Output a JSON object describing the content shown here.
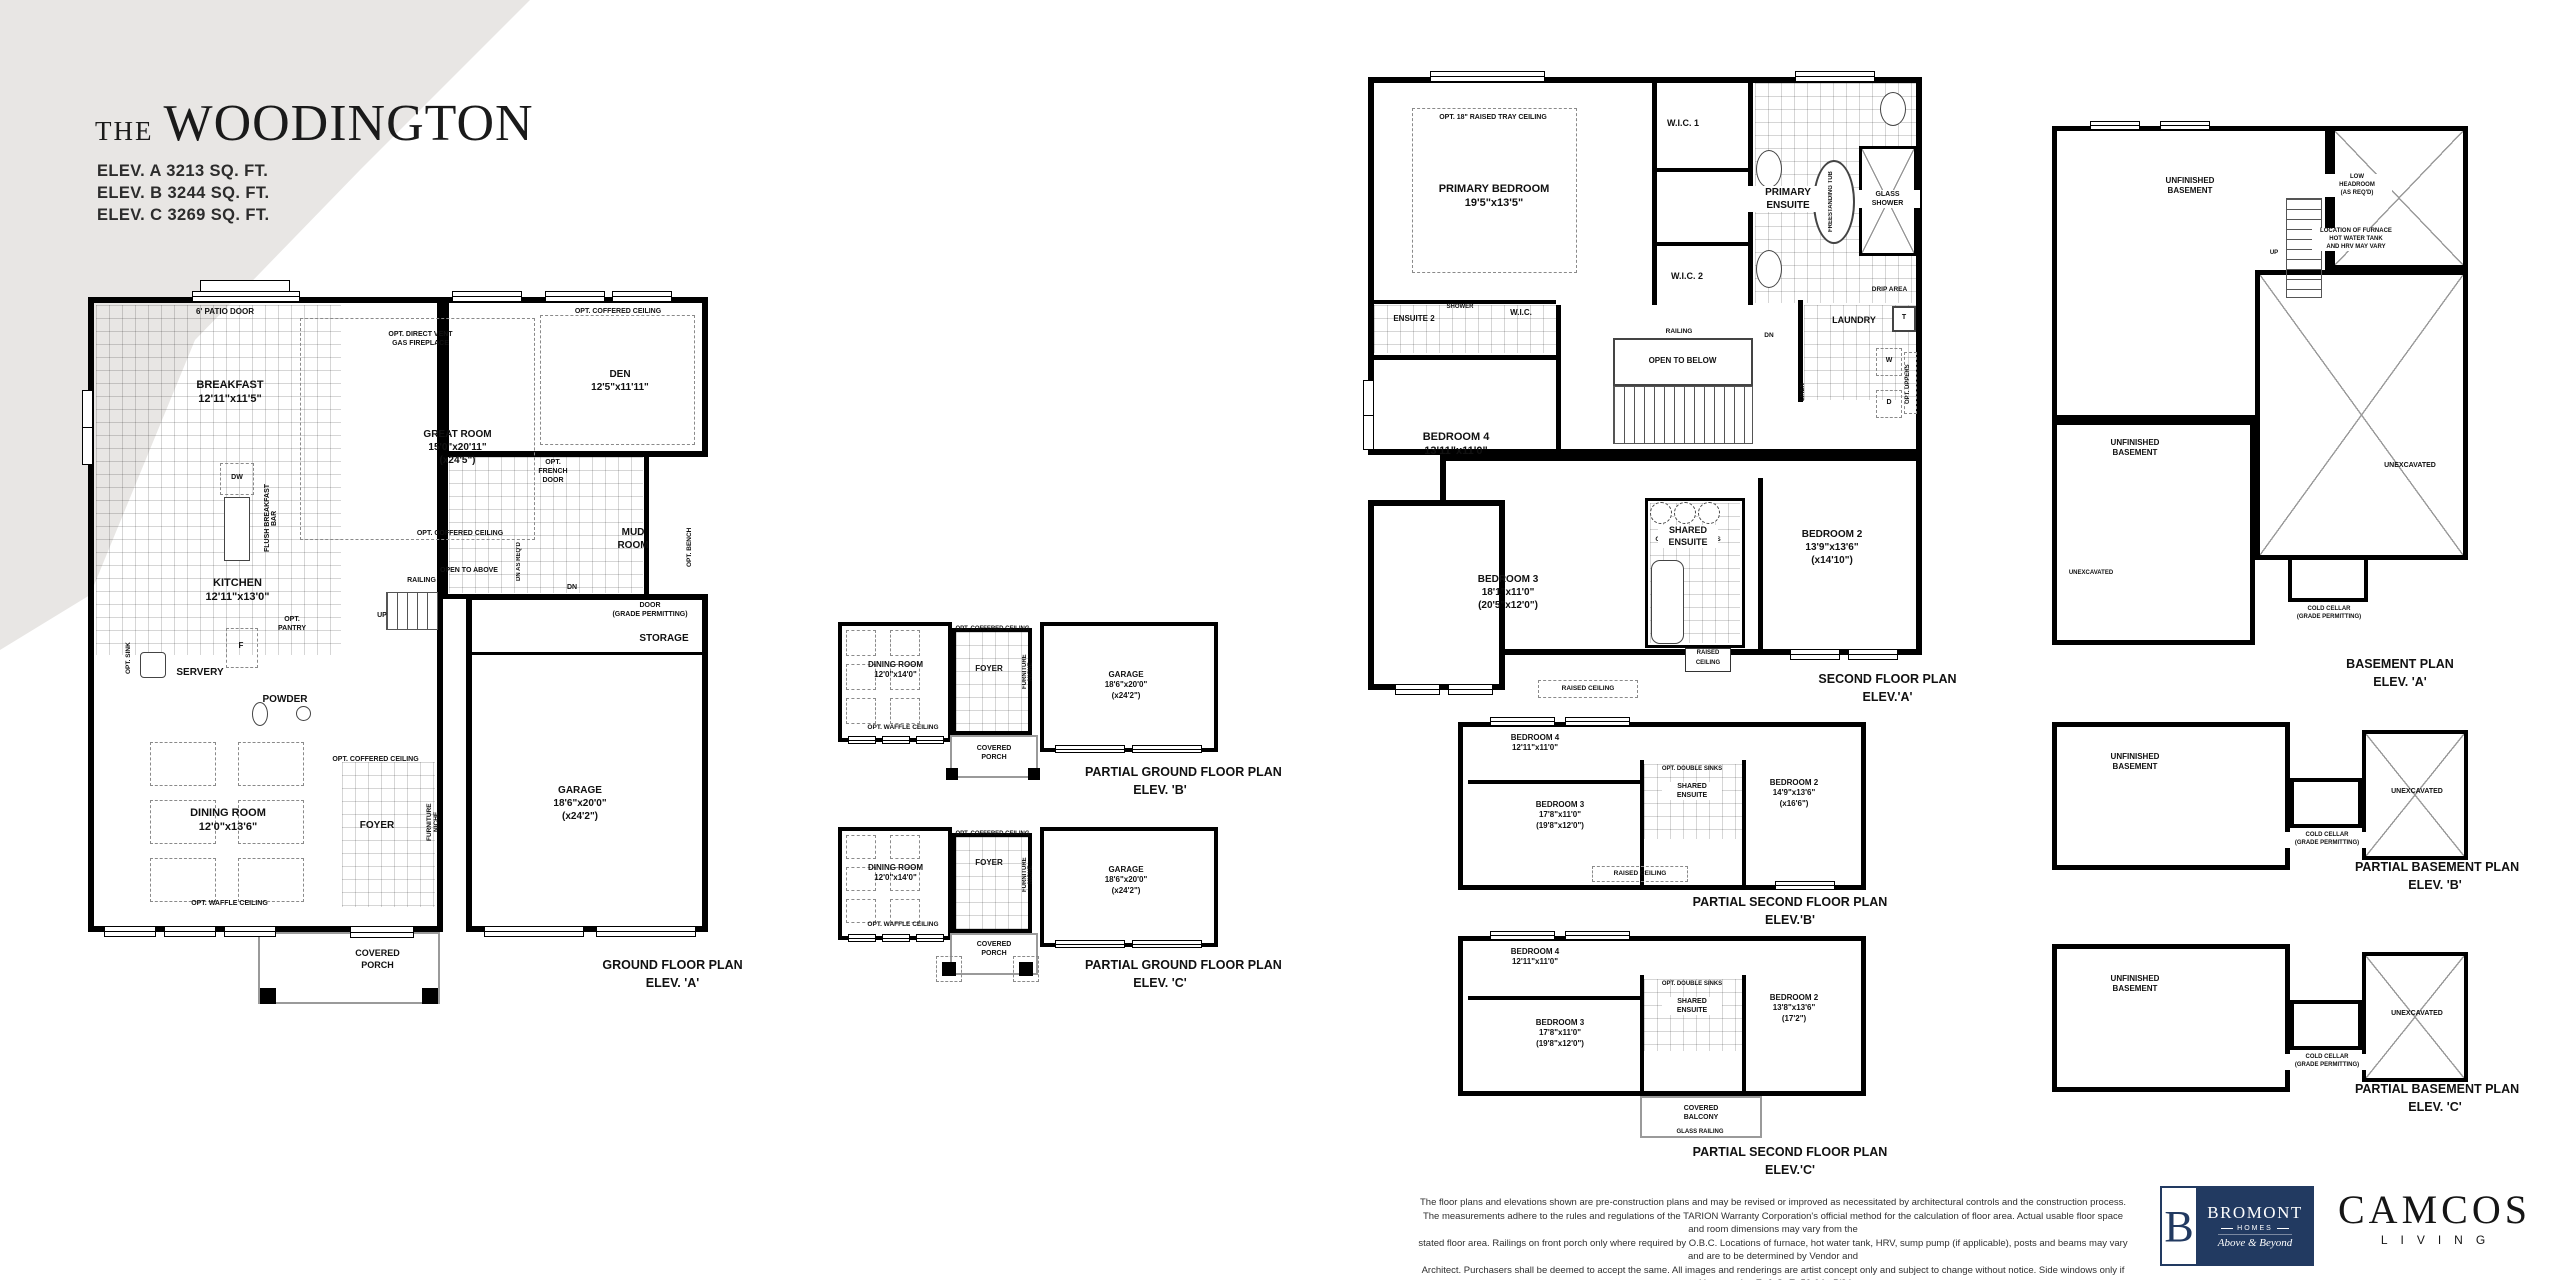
{
  "colors": {
    "paper": "#ffffff",
    "wedge": "#e8e6e4",
    "ink": "#111111",
    "bromont_navy": "#223a61"
  },
  "header": {
    "title_the": "THE",
    "title_name": "WOODINGTON",
    "elevations": [
      "ELEV. A 3213 SQ. FT.",
      "ELEV. B 3244 SQ. FT.",
      "ELEV. C 3269 SQ. FT."
    ]
  },
  "plans": {
    "ground_a": {
      "caption": [
        "GROUND FLOOR PLAN",
        "ELEV. 'A'"
      ],
      "labels": {
        "patio_door": "6' PATIO DOOR",
        "breakfast": [
          "BREAKFAST",
          "12'11\"x11'5\""
        ],
        "fireplace": [
          "OPT. DIRECT VENT",
          "GAS FIREPLACE"
        ],
        "great_room": [
          "GREAT ROOM",
          "15'0\"x20'11\"",
          "(x24'5\")"
        ],
        "great_coffered": "OPT. COFFERED CEILING",
        "den": [
          "DEN",
          "12'5\"x11'11\""
        ],
        "den_coffered": "OPT. COFFERED CEILING",
        "dw": "DW",
        "flush_bar": "FLUSH BREAKFAST BAR",
        "kitchen": [
          "KITCHEN",
          "12'11\"x13'0\""
        ],
        "fridge": "F",
        "pantry": [
          "OPT.",
          "PANTRY"
        ],
        "opt_sink": "OPT. SINK",
        "servery": "SERVERY",
        "powder": "POWDER",
        "open_above": "OPEN TO ABOVE",
        "railing": "RAILING",
        "up": "UP",
        "dn_reqd": "DN AS REQ'D",
        "french_door": [
          "OPT.",
          "FRENCH",
          "DOOR"
        ],
        "mud": [
          "MUD",
          "ROOM"
        ],
        "bench": "OPT. BENCH",
        "dn": "DN",
        "door_grade": [
          "DOOR",
          "(GRADE PERMITTING)"
        ],
        "storage": "STORAGE",
        "dining": [
          "DINING ROOM",
          "12'0\"x13'6\""
        ],
        "waffle": "OPT. WAFFLE CEILING",
        "foyer_coffered": "OPT. COFFERED CEILING",
        "foyer": "FOYER",
        "niche": "FURNITURE NICHE",
        "garage": [
          "GARAGE",
          "18'6\"x20'0\"",
          "(x24'2\")"
        ],
        "porch": [
          "COVERED",
          "PORCH"
        ]
      }
    },
    "partial_ground_b": {
      "caption": [
        "PARTIAL GROUND FLOOR PLAN",
        "ELEV. 'B'"
      ],
      "labels": {
        "dining": [
          "DINING ROOM",
          "12'0\"x14'0\""
        ],
        "coffered": "OPT. COFFERED CEILING",
        "foyer": "FOYER",
        "niche": "FURNITURE NICHE",
        "waffle": "OPT. WAFFLE CEILING",
        "porch": [
          "COVERED",
          "PORCH"
        ],
        "garage": [
          "GARAGE",
          "18'6\"x20'0\"",
          "(x24'2\")"
        ]
      }
    },
    "partial_ground_c": {
      "caption": [
        "PARTIAL GROUND FLOOR PLAN",
        "ELEV. 'C'"
      ],
      "labels": {
        "dining": [
          "DINING ROOM",
          "12'0\"x14'0\""
        ],
        "coffered": "OPT. COFFERED CEILING",
        "foyer": "FOYER",
        "niche": "FURNITURE NICHE",
        "waffle": "OPT. WAFFLE CEILING",
        "porch": [
          "COVERED",
          "PORCH"
        ],
        "garage": [
          "GARAGE",
          "18'6\"x20'0\"",
          "(x24'2\")"
        ]
      }
    },
    "second_a": {
      "caption": [
        "SECOND FLOOR PLAN",
        "ELEV.'A'"
      ],
      "labels": {
        "tray": "OPT. 18\" RAISED TRAY CEILING",
        "primary": [
          "PRIMARY BEDROOM",
          "19'5\"x13'5\""
        ],
        "wic1": "W.I.C. 1",
        "wic2": "W.I.C. 2",
        "ensuite": [
          "PRIMARY",
          "ENSUITE"
        ],
        "tub": "FREESTANDING TUB",
        "glass_shower": [
          "GLASS",
          "SHOWER"
        ],
        "drip": "DRIP AREA",
        "ensuite2": "ENSUITE 2",
        "shower": "SHOWER",
        "wic": "W.I.C.",
        "railing": "RAILING",
        "open_below": "OPEN TO BELOW",
        "dn": "DN",
        "laundry": "LAUNDRY",
        "linen": "LINEN",
        "w": "W",
        "d": "D",
        "t": "T",
        "uppers": "OPT. UPPERS",
        "bed4": [
          "BEDROOM 4",
          "13'11\"x11'0\""
        ],
        "sinks": "OPT. DOUBLE SINKS",
        "bed3": [
          "BEDROOM 3",
          "18'1\"x11'0\"",
          "(20'5\"x12'0\")"
        ],
        "shared": [
          "SHARED",
          "ENSUITE"
        ],
        "bed2": [
          "BEDROOM 2",
          "13'9\"x13'6\"",
          "(x14'10\")"
        ],
        "raised1": [
          "RAISED",
          "CEILING"
        ],
        "raised2": "RAISED CEILING"
      }
    },
    "partial_second_b": {
      "caption": [
        "PARTIAL SECOND FLOOR PLAN",
        "ELEV.'B'"
      ],
      "labels": {
        "bed4": [
          "BEDROOM 4",
          "12'11\"x11'0\""
        ],
        "bed3": [
          "BEDROOM 3",
          "17'8\"x11'0\"",
          "(19'8\"x12'0\")"
        ],
        "sinks": "OPT. DOUBLE SINKS",
        "shared": [
          "SHARED",
          "ENSUITE"
        ],
        "bed2": [
          "BEDROOM 2",
          "14'9\"x13'6\"",
          "(x16'6\")"
        ],
        "raised": "RAISED CEILING"
      }
    },
    "partial_second_c": {
      "caption": [
        "PARTIAL SECOND FLOOR PLAN",
        "ELEV.'C'"
      ],
      "labels": {
        "bed4": [
          "BEDROOM 4",
          "12'11\"x11'0\""
        ],
        "bed3": [
          "BEDROOM 3",
          "17'8\"x11'0\"",
          "(19'8\"x12'0\")"
        ],
        "sinks": "OPT. DOUBLE SINKS",
        "shared": [
          "SHARED",
          "ENSUITE"
        ],
        "bed2": [
          "BEDROOM 2",
          "13'8\"x13'6\"",
          "(17'2\")"
        ],
        "balcony": [
          "COVERED",
          "BALCONY"
        ],
        "glass_rail": "GLASS RAILING"
      }
    },
    "basement_a": {
      "caption": [
        "BASEMENT PLAN",
        "ELEV. 'A'"
      ],
      "labels": {
        "unfinished1": [
          "UNFINISHED",
          "BASEMENT"
        ],
        "low_headroom": [
          "LOW",
          "HEADROOM",
          "(AS REQ'D)"
        ],
        "furnace_note": [
          "LOCATION OF FURNACE",
          "HOT WATER TANK",
          "AND HRV MAY VARY"
        ],
        "up": "UP",
        "unfinished2": [
          "UNFINISHED",
          "BASEMENT"
        ],
        "unexcavated1": "UNEXCAVATED",
        "unexcavated2": "UNEXCAVATED",
        "cold_cellar": [
          "COLD CELLAR",
          "(GRADE PERMITTING)"
        ]
      }
    },
    "partial_basement_b": {
      "caption": [
        "PARTIAL BASEMENT PLAN",
        "ELEV. 'B'"
      ],
      "labels": {
        "unfinished": [
          "UNFINISHED",
          "BASEMENT"
        ],
        "unexcavated": "UNEXCAVATED",
        "cold_cellar": [
          "COLD CELLAR",
          "(GRADE PERMITTING)"
        ]
      }
    },
    "partial_basement_c": {
      "caption": [
        "PARTIAL BASEMENT PLAN",
        "ELEV. 'C'"
      ],
      "labels": {
        "unfinished": [
          "UNFINISHED",
          "BASEMENT"
        ],
        "unexcavated": "UNEXCAVATED",
        "cold_cellar": [
          "COLD CELLAR",
          "(GRADE PERMITTING)"
        ]
      }
    }
  },
  "footer": {
    "disclaimer": [
      "The floor plans and elevations shown are pre-construction plans and may be revised or improved as necessitated by architectural controls and the construction process.",
      "The measurements adhere to the rules and regulations of the TARION Warranty Corporation's official method for the calculation of floor area. Actual usable floor space and room dimensions may vary from the",
      "stated floor area. Railings on front porch only where required by O.B.C. Locations of furnace, hot water tank, HRV, sump pump (if applicable), posts and beams may vary and are to be determined by Vendor and",
      "Architect. Purchasers shall be deemed to accept the same. All images and renderings are artist concept only and subject to change without notice. Side windows only if siting permits. E. & O. E.  50-04 - 5/24"
    ],
    "bromont": {
      "initial": "B",
      "name": "BROMONT",
      "sub": "HOMES",
      "tagline": "Above & Beyond"
    },
    "camcos": {
      "name": "CAMCOS",
      "sub": "LIVING"
    }
  }
}
